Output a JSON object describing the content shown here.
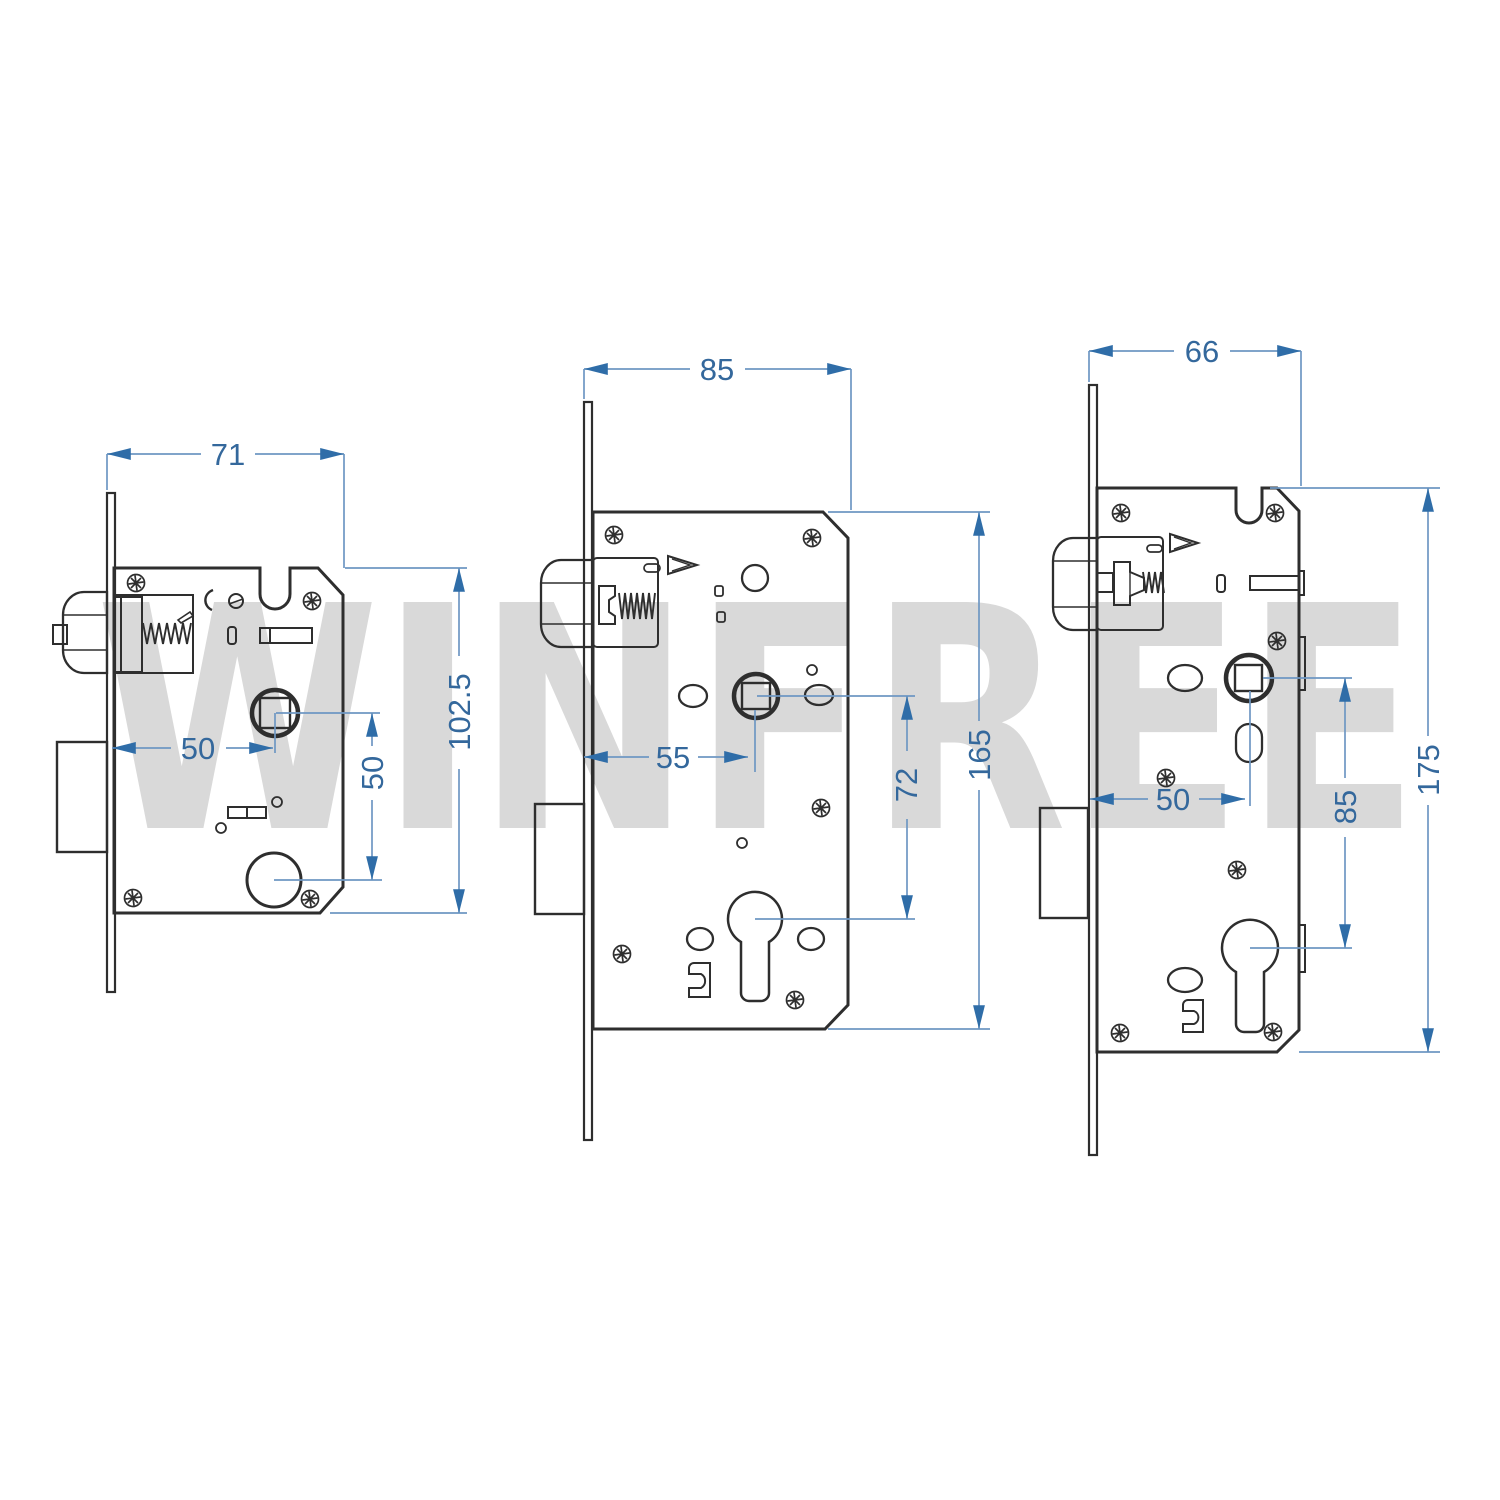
{
  "watermark": {
    "text": "WINFREE",
    "color": "#d9d9d9"
  },
  "colors": {
    "background": "#ffffff",
    "drawing_line": "#2e2e2e",
    "dimension_line": "#6e97c3",
    "dimension_text": "#34689c",
    "arrow": "#2f6da8"
  },
  "drawing": {
    "type": "technical-dimension-drawing",
    "subject": "three mortise lock bodies",
    "units_shown": "mm (implied)"
  },
  "locks": [
    {
      "id": "left",
      "dims": {
        "width": "71",
        "height": "102.5",
        "backset": "50",
        "hole_spacing": "50"
      }
    },
    {
      "id": "middle",
      "dims": {
        "width": "85",
        "height": "165",
        "backset": "55",
        "hole_spacing": "72"
      }
    },
    {
      "id": "right",
      "dims": {
        "width": "66",
        "height": "175",
        "backset": "50",
        "hole_spacing": "85"
      }
    }
  ]
}
